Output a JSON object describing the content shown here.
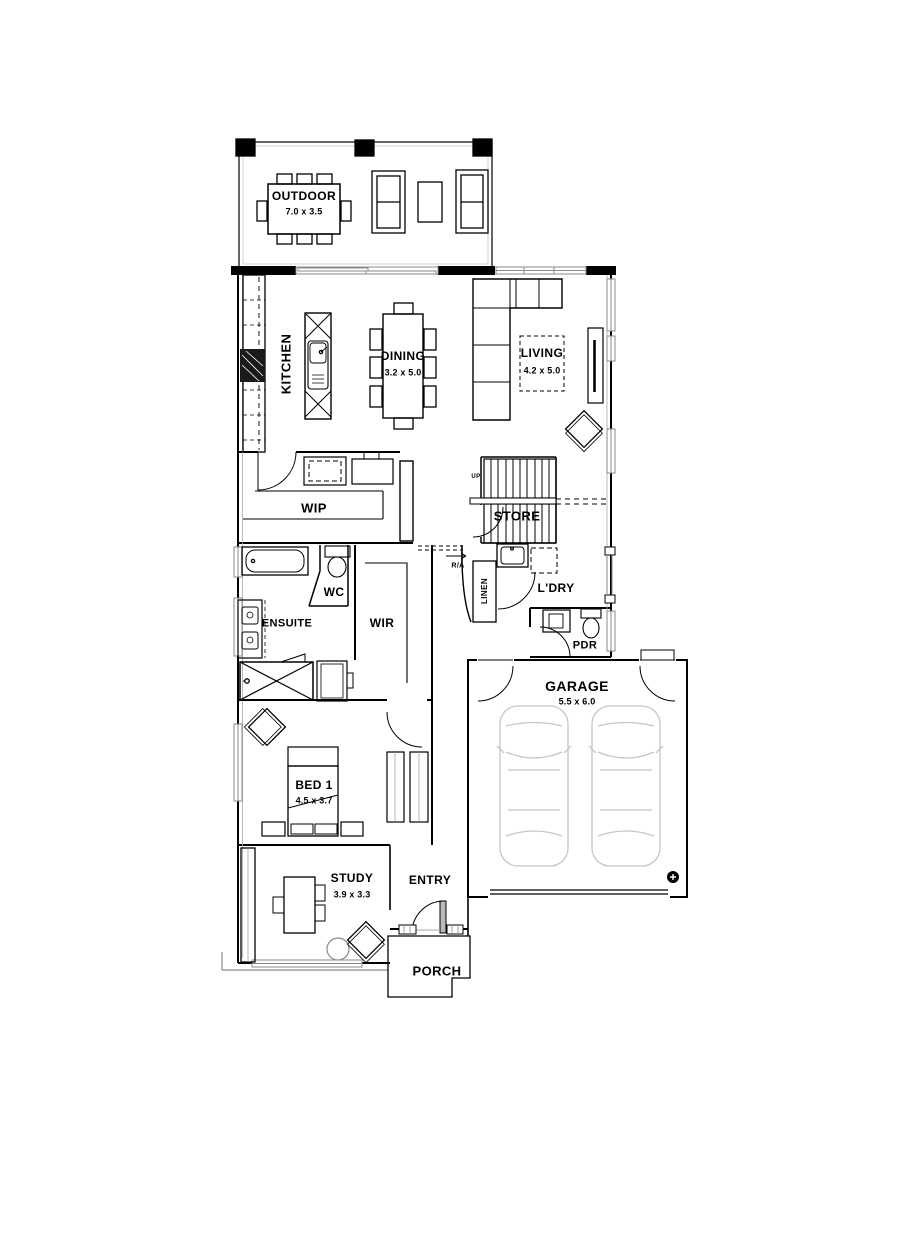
{
  "rooms": {
    "outdoor": {
      "name": "OUTDOOR",
      "dims": "7.0 x 3.5"
    },
    "kitchen": {
      "name": "KITCHEN"
    },
    "dining": {
      "name": "DINING",
      "dims": "3.2 x 5.0"
    },
    "living": {
      "name": "LIVING",
      "dims": "4.2 x 5.0"
    },
    "wip": {
      "name": "WIP"
    },
    "store": {
      "name": "STORE"
    },
    "wc": {
      "name": "WC"
    },
    "ensuite": {
      "name": "ENSUITE"
    },
    "wir": {
      "name": "WIR"
    },
    "linen": {
      "name": "LINEN"
    },
    "laundry": {
      "name": "L'DRY"
    },
    "powder": {
      "name": "PDR"
    },
    "garage": {
      "name": "GARAGE",
      "dims": "5.5 x 6.0"
    },
    "bed1": {
      "name": "BED 1",
      "dims": "4.5 x 3.7"
    },
    "study": {
      "name": "STUDY",
      "dims": "3.9 x 3.3"
    },
    "entry": {
      "name": "ENTRY"
    },
    "porch": {
      "name": "PORCH"
    }
  },
  "annotations": {
    "stairs_direction": "UP",
    "return_air": "R/A"
  },
  "colors": {
    "line": "#000000",
    "secondary_line": "#8a8a8a",
    "car_outline": "#c6c6c6",
    "background": "#ffffff"
  }
}
